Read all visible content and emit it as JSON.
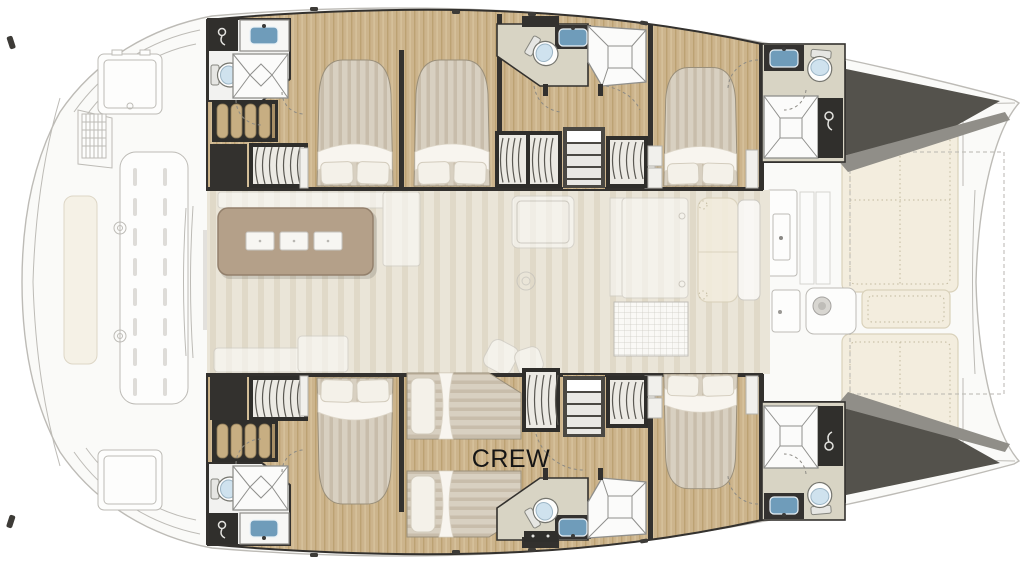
{
  "floorplan": {
    "labels": {
      "crew_cabin": "CREW"
    },
    "colors": {
      "wood-base": "#ccb48c",
      "wood-grain": "#bca273",
      "wood-light": "#dbc9a4",
      "saloon-base": "#eae5d8",
      "saloon-grain": "#e0d9c8",
      "wall-dark": "#33312e",
      "wall-mid": "#55524d",
      "mattress": "#d8d0c1",
      "mattress-stripe": "#c8bdab",
      "pillow": "#f4f1e9",
      "pillow-edge": "#d2cbbc",
      "linen": "#f8f5ef",
      "bath-floor": "#f2f2f0",
      "bath-floor-warm": "#d8d4c4",
      "glass": "#fbfbfa",
      "glass-line": "#8f8f8c",
      "fixture-blue": "#6f9cba",
      "fixture-blue-light": "#cfe2ee",
      "island": "#b4a089",
      "island-edge": "#93806c",
      "stool": "#f7f6f2",
      "ghost-fill": "#fafaf8",
      "ghost-line": "#bdbbb6",
      "ghost-dark": "#a9a7a2",
      "cream": "#f3edde",
      "cream-edge": "#d9d1ba",
      "cream-dot": "#c2b99e",
      "tread": "#e9e8e4",
      "dark-wedge": "#54524c",
      "mid-wedge": "#908e88",
      "label-ink": "#161616"
    },
    "icons": {
      "shower-head": "circle-with-hose-curve",
      "door-swing": "dashed-quarter-arc",
      "winch": "concentric-circles",
      "hangers": "repeated-arc-strokes"
    }
  }
}
